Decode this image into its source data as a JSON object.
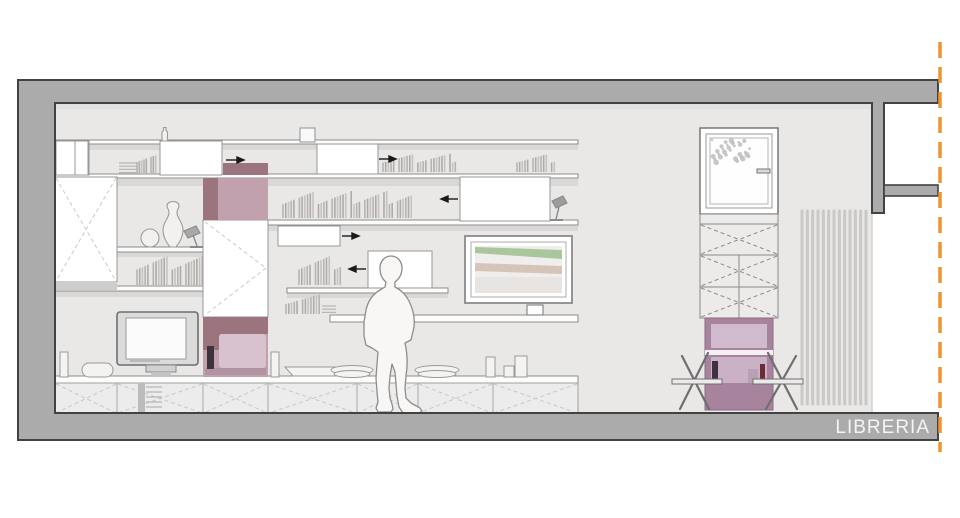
{
  "title": {
    "label": "LIBRERIA"
  },
  "palette": {
    "wall_fill": "#acabab",
    "wall_outline": "#424242",
    "room_bg": "#e9e8e7",
    "section_line": "#ef9433",
    "mauve_dark": "#9b747d",
    "mauve_mid": "#c2a1af",
    "mauve_light": "#d7c2cd",
    "mauve_base": "#b193a2",
    "violet_frame": "#a8839d",
    "violet_light_top": "#d0bacd",
    "violet_light_bottom": "#cbb1c6",
    "art_green": "#a9c69d",
    "art_tan": "#d6c4b8",
    "bottle_dark": "#3f323c",
    "bottle_red": "#6e2b35",
    "label_color": "#f4f4f4"
  },
  "generated": {
    "radiator": {
      "x": 802,
      "y": 211,
      "width": 64,
      "height": 193,
      "tubes": 13
    },
    "foliage": {
      "x": 712,
      "y": 140,
      "width": 38,
      "height": 28,
      "count": 30
    },
    "books": [
      {
        "x": 137,
        "base": 174,
        "w": 21,
        "h": 22,
        "n": 9
      },
      {
        "x": 383,
        "base": 173,
        "w": 75,
        "h": 19,
        "n": 28
      },
      {
        "x": 517,
        "base": 173,
        "w": 40,
        "h": 19,
        "n": 15
      },
      {
        "x": 283,
        "base": 219,
        "w": 131,
        "h": 28,
        "n": 48
      },
      {
        "x": 299,
        "base": 286,
        "w": 44,
        "h": 31,
        "n": 16
      },
      {
        "x": 286,
        "base": 315,
        "w": 36,
        "h": 20,
        "n": 13
      },
      {
        "x": 137,
        "base": 286,
        "w": 68,
        "h": 31,
        "n": 25
      }
    ],
    "stacks": [
      {
        "x": 119,
        "y": 163,
        "w": 19,
        "lines": 4
      },
      {
        "x": 322,
        "y": 306,
        "w": 14,
        "lines": 3
      }
    ]
  }
}
